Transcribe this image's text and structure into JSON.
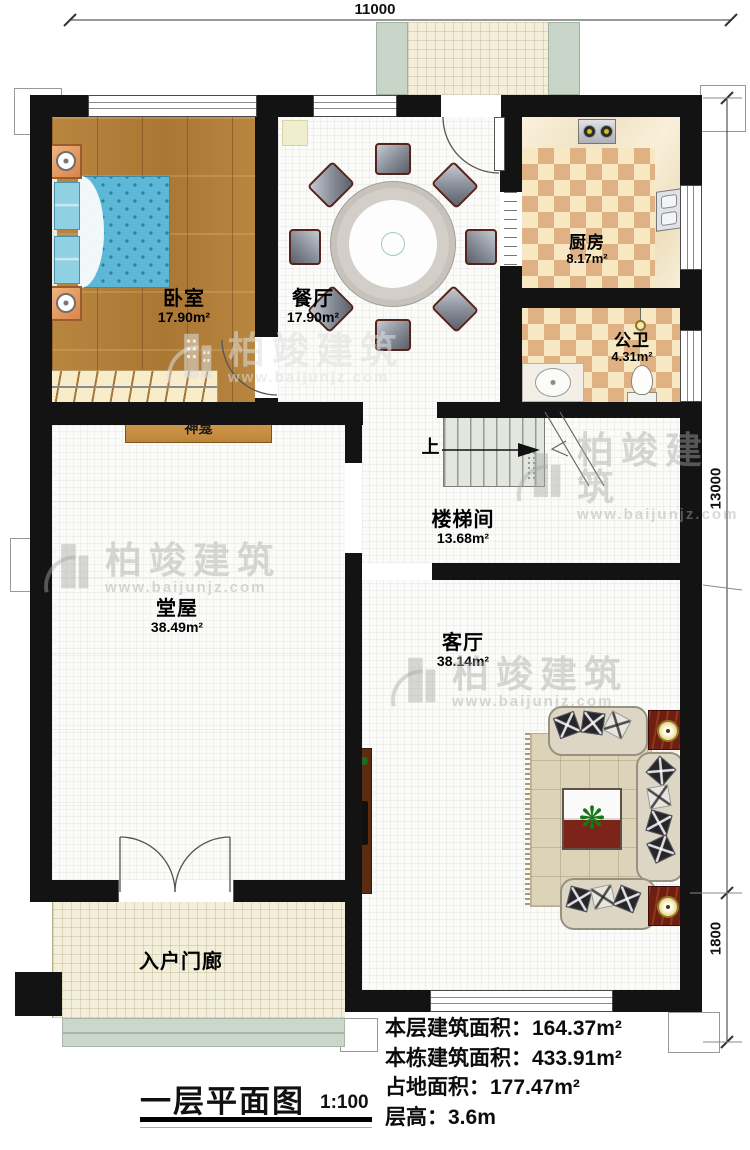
{
  "dimensions": {
    "top": "11000",
    "right_main": "13000",
    "right_lower": "1800"
  },
  "rooms": {
    "bedroom": {
      "name": "卧室",
      "area": "17.90m²"
    },
    "dining": {
      "name": "餐厅",
      "area": "17.90m²"
    },
    "kitchen": {
      "name": "厨房",
      "area": "8.17m²"
    },
    "bathroom": {
      "name": "公卫",
      "area": "4.31m²"
    },
    "stairwell": {
      "name": "楼梯间",
      "area": "13.68m²"
    },
    "hall": {
      "name": "堂屋",
      "area": "38.49m²"
    },
    "living": {
      "name": "客厅",
      "area": "38.14m²"
    },
    "entry_porch": {
      "name": "入户门廊"
    }
  },
  "annotations": {
    "shrine": "神龛",
    "stairs_up": "上"
  },
  "title_block": {
    "title": "一层平面图",
    "scale": "1:100"
  },
  "stats": [
    {
      "label": "本层建筑面积：",
      "value": "164.37m²"
    },
    {
      "label": "本栋建筑面积：",
      "value": "433.91m²"
    },
    {
      "label": "占地面积：",
      "value": "177.47m²"
    },
    {
      "label": "层高：",
      "value": "3.6m"
    }
  ],
  "watermark": {
    "brand": "柏竣建筑",
    "url": "www.baijunjz.com"
  },
  "colors": {
    "wall": "#131313",
    "wood_floor": "#b5823f",
    "checker_light": "#f7e7c2",
    "checker_dark": "#e0b183",
    "porch_tile": "#f3efda",
    "shrine_wood": "#c9944a",
    "sofa": "#ddd6c5",
    "rug": "#ddd3b8",
    "table_red": "#7c241a"
  }
}
